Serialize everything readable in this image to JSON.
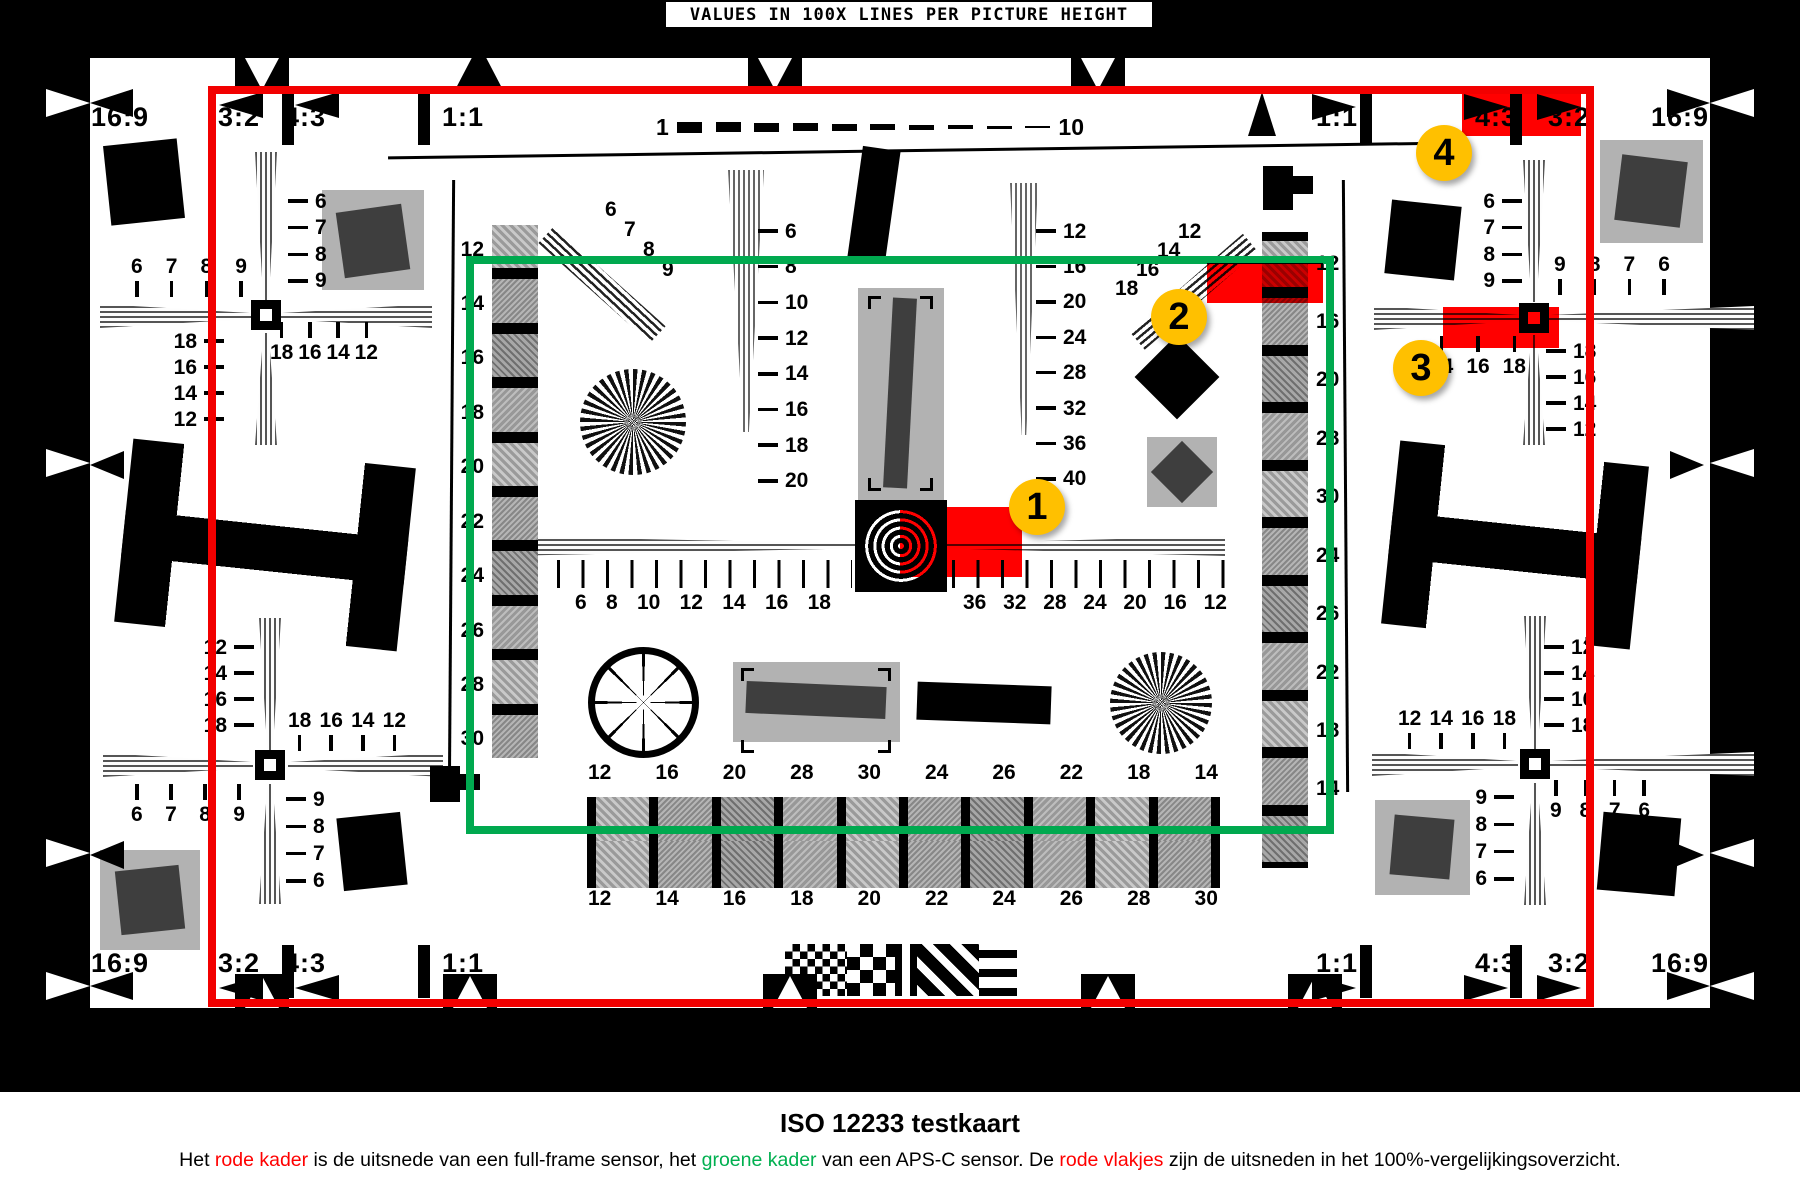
{
  "title_bar": {
    "text": "VALUES IN 100X LINES PER PICTURE HEIGHT"
  },
  "colors": {
    "frame_red": "#f20000",
    "frame_green": "#00a94f",
    "badge_gold": "#ffc000",
    "patch_red": "#ff0000",
    "text_red": "#ff0000",
    "text_green": "#00b050"
  },
  "aspect_labels": {
    "top": [
      "16:9",
      "3:2",
      "4:3",
      "1:1",
      "1:1",
      "4:3",
      "3:2",
      "16:9"
    ],
    "bottom": [
      "16:9",
      "3:2",
      "4:3",
      "1:1",
      "1:1",
      "4:3",
      "3:2",
      "16:9"
    ]
  },
  "dash_line": {
    "start": "1",
    "end": "10"
  },
  "badges": [
    "1",
    "2",
    "3",
    "4"
  ],
  "scales": {
    "ruler_left": [
      "6",
      "8",
      "10",
      "12",
      "14",
      "16",
      "18"
    ],
    "ruler_right": [
      "36",
      "32",
      "28",
      "24",
      "20",
      "16",
      "12"
    ],
    "center_left_col": [
      "6",
      "8",
      "10",
      "12",
      "14",
      "16",
      "18",
      "20"
    ],
    "center_right_col": [
      "12",
      "16",
      "20",
      "24",
      "28",
      "32",
      "36",
      "40"
    ],
    "left_strip": [
      "12",
      "14",
      "16",
      "18",
      "20",
      "22",
      "24",
      "26",
      "28",
      "30"
    ],
    "right_strip": [
      "12",
      "16",
      "20",
      "28",
      "30",
      "24",
      "26",
      "22",
      "18",
      "14"
    ],
    "bottom_strip_top": [
      "12",
      "16",
      "20",
      "28",
      "30",
      "24",
      "26",
      "22",
      "18",
      "14"
    ],
    "bottom_strip_bottom": [
      "12",
      "14",
      "16",
      "18",
      "20",
      "22",
      "24",
      "26",
      "28",
      "30"
    ],
    "diag_left": [
      "6",
      "7",
      "8",
      "9"
    ],
    "diag_right": [
      "12",
      "14",
      "16",
      "18"
    ],
    "tl_top": [
      "6",
      "7",
      "8",
      "9"
    ],
    "tl_right": [
      "6",
      "7",
      "8",
      "9"
    ],
    "tl_bottom": [
      "18",
      "16",
      "14",
      "12"
    ],
    "tl_left": [
      "18",
      "16",
      "14",
      "12"
    ],
    "bl_left": [
      "12",
      "14",
      "16",
      "18"
    ],
    "bl_mid": [
      "18",
      "16",
      "14",
      "12"
    ],
    "bl_bottom": [
      "6",
      "7",
      "8",
      "9"
    ],
    "bl_right": [
      "9",
      "8",
      "7",
      "6"
    ],
    "tr_left": [
      "6",
      "7",
      "8",
      "9"
    ],
    "tr_top": [
      "9",
      "8",
      "7",
      "6"
    ],
    "tr_bottom": [
      "14",
      "16",
      "18"
    ],
    "tr_right": [
      "18",
      "16",
      "14",
      "12"
    ],
    "br_right": [
      "12",
      "14",
      "16",
      "18"
    ],
    "br_mid": [
      "12",
      "14",
      "16",
      "18"
    ],
    "br_left": [
      "9",
      "8",
      "7",
      "6"
    ],
    "br_bottom": [
      "9",
      "8",
      "7",
      "6"
    ]
  },
  "caption": {
    "title": "ISO 12233 testkaart",
    "segments": [
      {
        "text": "Het ",
        "color": "black"
      },
      {
        "text": "rode kader",
        "color": "red"
      },
      {
        "text": " is de uitsnede van een full-frame sensor, het ",
        "color": "black"
      },
      {
        "text": "groene kader",
        "color": "green"
      },
      {
        "text": " van een APS-C sensor. De ",
        "color": "black"
      },
      {
        "text": "rode vlakjes",
        "color": "red"
      },
      {
        "text": " zijn de uitsneden in het 100%-vergelijkingsoverzicht.",
        "color": "black"
      }
    ]
  }
}
